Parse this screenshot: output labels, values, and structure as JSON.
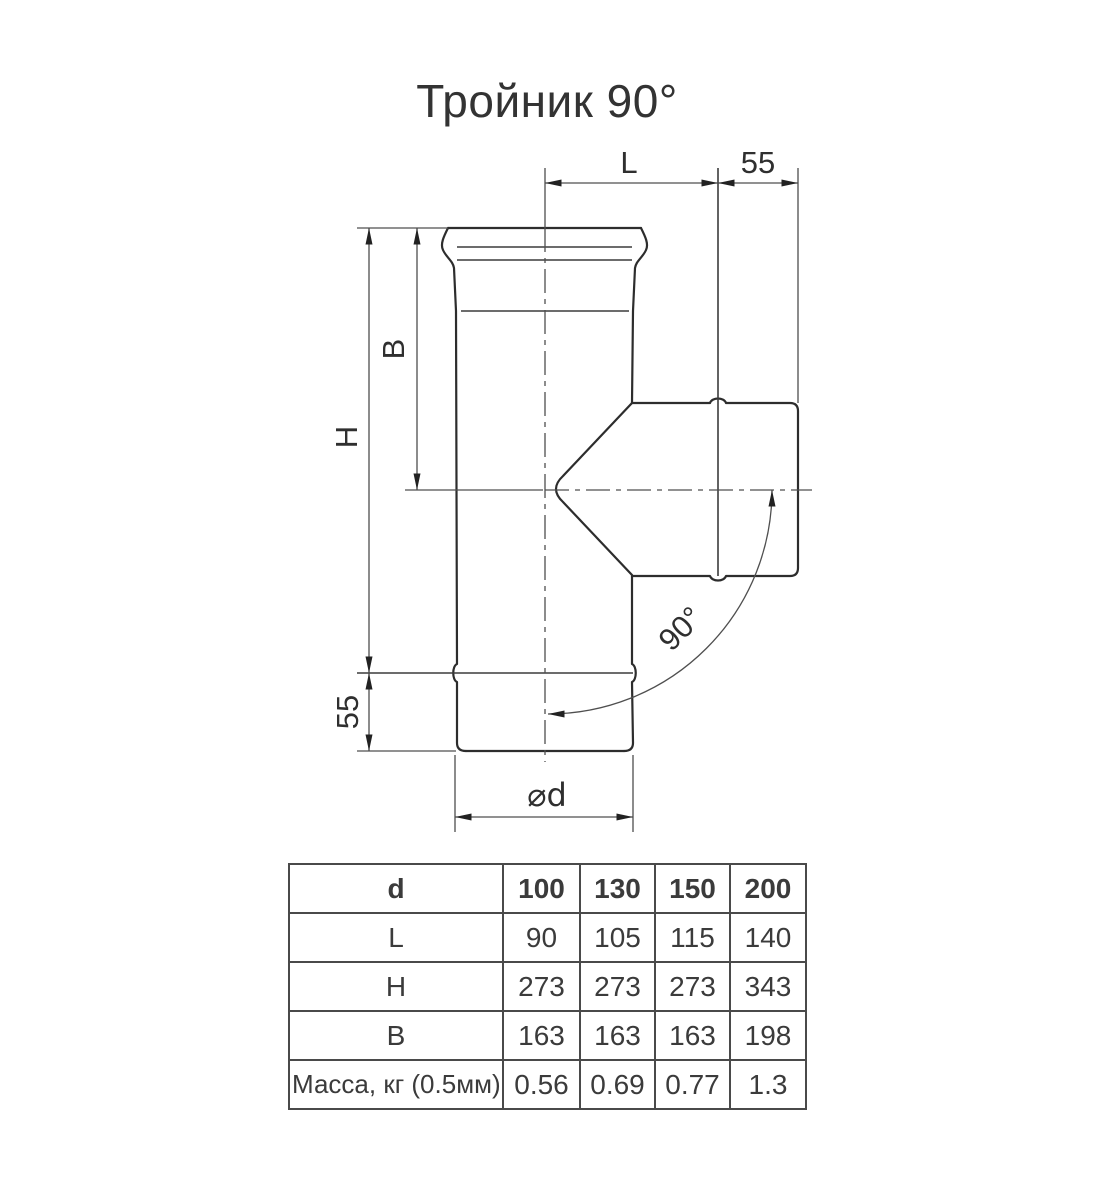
{
  "title": "Тройник 90°",
  "drawing": {
    "labels": {
      "length_l": "L",
      "offset_top": "55",
      "height_h": "H",
      "branch_height_b": "B",
      "offset_bottom": "55",
      "diameter": "⌀d",
      "angle": "90°"
    },
    "colors": {
      "outline": "#2d2d2d",
      "thin_line": "#4f4f4f",
      "text": "#2f2f2f"
    }
  },
  "table": {
    "header": [
      "d",
      "100",
      "130",
      "150",
      "200"
    ],
    "rows": [
      {
        "label": "L",
        "values": [
          "90",
          "105",
          "115",
          "140"
        ]
      },
      {
        "label": "H",
        "values": [
          "273",
          "273",
          "273",
          "343"
        ]
      },
      {
        "label": "B",
        "values": [
          "163",
          "163",
          "163",
          "198"
        ]
      },
      {
        "label": "Масса, кг (0.5мм)",
        "values": [
          "0.56",
          "0.69",
          "0.77",
          "1.3"
        ]
      }
    ]
  }
}
